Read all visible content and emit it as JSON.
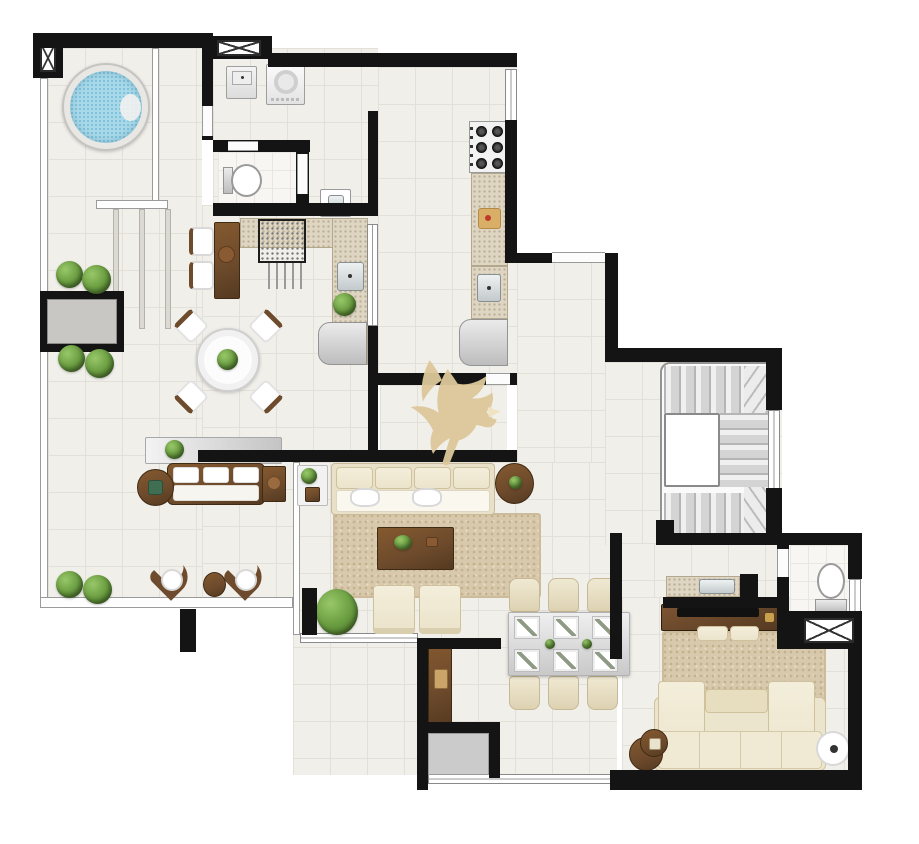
{
  "palette": {
    "background": "#ffffff",
    "wall": "#141414",
    "floor_tile": "#f1efea",
    "floor_grid": "#e3e0d9",
    "bath_tile": "#f7f6f3",
    "granite": "#ded5c2",
    "granite_speckle": "#b9ad92",
    "wood": "#6e4b2c",
    "wood_dark": "#553a21",
    "cream": "#ece4cb",
    "cream_border": "#cfc19c",
    "rug": "#d8c9ac",
    "rug_speckle": "#c3b190",
    "water": "#a9d9e9",
    "water_speckle": "#7cc2da",
    "plant": "#679a3e",
    "plant_dark": "#46702a",
    "metal": "#c3cacc",
    "appliance": "#bdbdbd",
    "rail_line": "#9a9a9a",
    "watermark": "#ddc89a"
  },
  "watermark": {
    "icon": "eagle-logo",
    "color": "#ddc89a"
  },
  "floorplan": {
    "type": "floor-plan",
    "rooms": [
      {
        "id": "terrace"
      },
      {
        "id": "laundry"
      },
      {
        "id": "wc"
      },
      {
        "id": "gourmet-area"
      },
      {
        "id": "kitchen"
      },
      {
        "id": "entry-hall"
      },
      {
        "id": "living-room"
      },
      {
        "id": "dining-room"
      },
      {
        "id": "stair-hall"
      },
      {
        "id": "corridor"
      },
      {
        "id": "tv-room"
      },
      {
        "id": "bathroom"
      }
    ],
    "furniture": [
      "jacuzzi",
      "pergola-deck",
      "planter-box",
      "garden-bushes",
      "laundry-tub",
      "washing-machine",
      "toilet",
      "hand-sink",
      "bbq-grill",
      "bar-counter",
      "bar-stools",
      "gourmet-sink",
      "minibar-fridge",
      "terrace-dining-table",
      "terrace-chairs",
      "sideboard",
      "outdoor-sofa",
      "outdoor-side-tables",
      "lounge-chairs",
      "pouf",
      "cooktop",
      "kitchen-counter",
      "cutting-board",
      "kitchen-sink",
      "refrigerator",
      "living-sofa",
      "area-rug",
      "coffee-table",
      "armchairs",
      "glass-side-table",
      "round-side-table",
      "dining-table-6-seats",
      "dining-chairs",
      "placemats",
      "buffet",
      "u-shaped-staircase",
      "under-stair-counter",
      "tv-console",
      "tv",
      "tv-rug",
      "ottomans",
      "tv-sofa-with-chaises",
      "round-tables",
      "floor-lamp",
      "bathroom-toilet",
      "service-shafts",
      "eagle-watermark"
    ]
  }
}
